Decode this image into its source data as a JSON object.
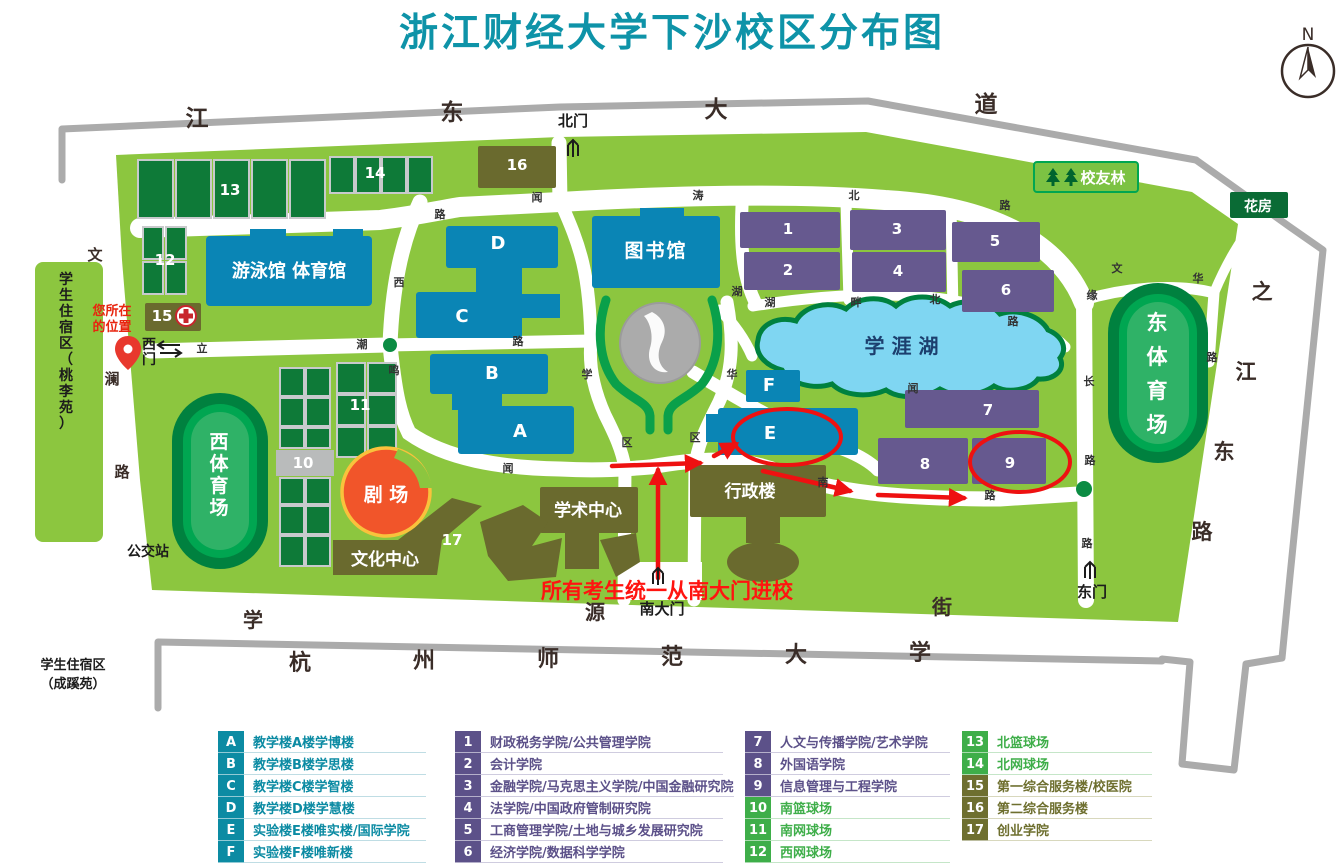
{
  "title": {
    "text": "浙江财经大学下沙校区分布图",
    "color": "#0E93A8"
  },
  "compass": {
    "label": "N"
  },
  "colors": {
    "campus_green": "#8CC63F",
    "road_edge_gray": "#ABABAB",
    "road_white": "#FFFFFF",
    "lake_water": "#7FD6F2",
    "lake_edge": "#00813F",
    "building_blue": "#0A85B5",
    "building_purple": "#66598F",
    "building_olive": "#6A6A2E",
    "court_green": "#0E7A38",
    "stadium_ring": "#00813F",
    "stadium_field": "#00A651",
    "theater_orange": "#F1552A",
    "theater_outline": "#F9C23C",
    "annotation_red": "#EE1111",
    "title_teal": "#0E93A8",
    "legend_teal": "#0C8BA3",
    "legend_purple": "#5C5189",
    "legend_green": "#3EAE49",
    "legend_olive": "#6E6F2F"
  },
  "legend": {
    "groups": [
      {
        "rows": [
          {
            "id": "A",
            "label": "教学楼A楼学博楼",
            "color": "#0C8BA3",
            "line": "#bfdde4"
          },
          {
            "id": "B",
            "label": "教学楼B楼学思楼",
            "color": "#0C8BA3",
            "line": "#bfdde4"
          },
          {
            "id": "C",
            "label": "教学楼C楼学智楼",
            "color": "#0C8BA3",
            "line": "#bfdde4"
          },
          {
            "id": "D",
            "label": "教学楼D楼学慧楼",
            "color": "#0C8BA3",
            "line": "#bfdde4"
          },
          {
            "id": "E",
            "label": "实验楼E楼唯实楼/国际学院",
            "color": "#0C8BA3",
            "line": "#bfdde4"
          },
          {
            "id": "F",
            "label": "实验楼F楼唯新楼",
            "color": "#0C8BA3",
            "line": "#bfdde4"
          }
        ]
      },
      {
        "rows": [
          {
            "id": "1",
            "label": "财政税务学院/公共管理学院",
            "color": "#5C5189",
            "line": "#cfccdf"
          },
          {
            "id": "2",
            "label": "会计学院",
            "color": "#5C5189",
            "line": "#cfccdf"
          },
          {
            "id": "3",
            "label": "金融学院/马克思主义学院/中国金融研究院",
            "color": "#5C5189",
            "line": "#cfccdf"
          },
          {
            "id": "4",
            "label": "法学院/中国政府管制研究院",
            "color": "#5C5189",
            "line": "#cfccdf"
          },
          {
            "id": "5",
            "label": "工商管理学院/土地与城乡发展研究院",
            "color": "#5C5189",
            "line": "#cfccdf"
          },
          {
            "id": "6",
            "label": "经济学院/数据科学学院",
            "color": "#5C5189",
            "line": "#cfccdf"
          }
        ]
      },
      {
        "rows": [
          {
            "id": "7",
            "label": "人文与传播学院/艺术学院",
            "color": "#5C5189",
            "line": "#cfccdf"
          },
          {
            "id": "8",
            "label": "外国语学院",
            "color": "#5C5189",
            "line": "#cfccdf"
          },
          {
            "id": "9",
            "label": "信息管理与工程学院",
            "color": "#5C5189",
            "line": "#cfccdf"
          },
          {
            "id": "10",
            "label": "南篮球场",
            "color": "#3EAE49",
            "line": "#c5e6c8"
          },
          {
            "id": "11",
            "label": "南网球场",
            "color": "#3EAE49",
            "line": "#c5e6c8"
          },
          {
            "id": "12",
            "label": "西网球场",
            "color": "#3EAE49",
            "line": "#c5e6c8"
          }
        ]
      },
      {
        "rows": [
          {
            "id": "13",
            "label": "北篮球场",
            "color": "#3EAE49",
            "line": "#c5e6c8"
          },
          {
            "id": "14",
            "label": "北网球场",
            "color": "#3EAE49",
            "line": "#c5e6c8"
          },
          {
            "id": "15",
            "label": "第一综合服务楼/校医院",
            "color": "#6E6F2F",
            "line": "#d8d8bd"
          },
          {
            "id": "16",
            "label": "第二综合服务楼",
            "color": "#6E6F2F",
            "line": "#d8d8bd"
          },
          {
            "id": "17",
            "label": "创业学院",
            "color": "#6E6F2F",
            "line": "#d8d8bd"
          }
        ]
      }
    ]
  },
  "map_texts": [
    {
      "n": "road-jiangdong-avenue",
      "t": "江",
      "x": 197,
      "y": 126,
      "s": 23,
      "c": "#3a2d28"
    },
    {
      "n": "road-jiangdong-avenue",
      "t": "东",
      "x": 452,
      "y": 120,
      "s": 23,
      "c": "#3a2d28"
    },
    {
      "n": "road-jiangdong-avenue",
      "t": "大",
      "x": 716,
      "y": 117,
      "s": 23,
      "c": "#3a2d28"
    },
    {
      "n": "road-jiangdong-avenue",
      "t": "道",
      "x": 986,
      "y": 112,
      "s": 23,
      "c": "#3a2d28"
    },
    {
      "n": "road-zhijiang-east",
      "t": "之",
      "x": 1262,
      "y": 299,
      "s": 21,
      "c": "#3a2d28"
    },
    {
      "n": "road-zhijiang-east",
      "t": "江",
      "x": 1246,
      "y": 379,
      "s": 21,
      "c": "#3a2d28"
    },
    {
      "n": "road-zhijiang-east",
      "t": "东",
      "x": 1224,
      "y": 459,
      "s": 21,
      "c": "#3a2d28"
    },
    {
      "n": "road-zhijiang-east",
      "t": "路",
      "x": 1202,
      "y": 539,
      "s": 21,
      "c": "#3a2d28"
    },
    {
      "n": "road-xueyuan-street",
      "t": "学",
      "x": 253,
      "y": 627,
      "s": 20,
      "c": "#3a2d28"
    },
    {
      "n": "road-xueyuan-street",
      "t": "源",
      "x": 595,
      "y": 619,
      "s": 20,
      "c": "#3a2d28"
    },
    {
      "n": "road-xueyuan-street",
      "t": "街",
      "x": 942,
      "y": 614,
      "s": 20,
      "c": "#3a2d28"
    },
    {
      "n": "hangzhou-normal-univ",
      "t": "杭",
      "x": 300,
      "y": 670,
      "s": 22,
      "c": "#3a2d28"
    },
    {
      "n": "hangzhou-normal-univ",
      "t": "州",
      "x": 424,
      "y": 668,
      "s": 22,
      "c": "#3a2d28"
    },
    {
      "n": "hangzhou-normal-univ",
      "t": "师",
      "x": 548,
      "y": 666,
      "s": 22,
      "c": "#3a2d28"
    },
    {
      "n": "hangzhou-normal-univ",
      "t": "范",
      "x": 672,
      "y": 664,
      "s": 22,
      "c": "#3a2d28"
    },
    {
      "n": "hangzhou-normal-univ",
      "t": "大",
      "x": 796,
      "y": 662,
      "s": 22,
      "c": "#3a2d28"
    },
    {
      "n": "hangzhou-normal-univ",
      "t": "学",
      "x": 920,
      "y": 660,
      "s": 22,
      "c": "#3a2d28"
    },
    {
      "n": "road-wenlan",
      "t": "文",
      "x": 95,
      "y": 260,
      "s": 15,
      "c": "#3a2d28"
    },
    {
      "n": "road-wenlan",
      "t": "澜",
      "x": 112,
      "y": 384,
      "s": 15,
      "c": "#3a2d28"
    },
    {
      "n": "road-wenlan",
      "t": "路",
      "x": 122,
      "y": 477,
      "s": 15,
      "c": "#3a2d28"
    },
    {
      "n": "road-char",
      "t": "闻",
      "x": 537,
      "y": 201,
      "s": 11,
      "c": "#333333"
    },
    {
      "n": "road-char",
      "t": "涛",
      "x": 698,
      "y": 199,
      "s": 11,
      "c": "#333333"
    },
    {
      "n": "road-char",
      "t": "北",
      "x": 854,
      "y": 199,
      "s": 11,
      "c": "#333333"
    },
    {
      "n": "road-char",
      "t": "路",
      "x": 1005,
      "y": 209,
      "s": 11,
      "c": "#333333"
    },
    {
      "n": "road-char",
      "t": "路",
      "x": 440,
      "y": 218,
      "s": 11,
      "c": "#333333"
    },
    {
      "n": "road-char",
      "t": "西",
      "x": 399,
      "y": 286,
      "s": 11,
      "c": "#333333"
    },
    {
      "n": "road-char",
      "t": "立",
      "x": 202,
      "y": 352,
      "s": 11,
      "c": "#333333"
    },
    {
      "n": "road-char",
      "t": "潮",
      "x": 362,
      "y": 348,
      "s": 11,
      "c": "#333333"
    },
    {
      "n": "road-char",
      "t": "鸣",
      "x": 394,
      "y": 374,
      "s": 11,
      "c": "#333333"
    },
    {
      "n": "road-char",
      "t": "路",
      "x": 518,
      "y": 345,
      "s": 11,
      "c": "#333333"
    },
    {
      "n": "road-char",
      "t": "闻",
      "x": 508,
      "y": 472,
      "s": 11,
      "c": "#333333"
    },
    {
      "n": "road-char",
      "t": "区",
      "x": 627,
      "y": 446,
      "s": 11,
      "c": "#333333"
    },
    {
      "n": "road-char",
      "t": "区",
      "x": 695,
      "y": 441,
      "s": 11,
      "c": "#333333"
    },
    {
      "n": "road-char",
      "t": "学",
      "x": 587,
      "y": 378,
      "s": 11,
      "c": "#333333"
    },
    {
      "n": "road-char",
      "t": "湖",
      "x": 737,
      "y": 295,
      "s": 11,
      "c": "#333333"
    },
    {
      "n": "road-char",
      "t": "华",
      "x": 732,
      "y": 378,
      "s": 11,
      "c": "#333333"
    },
    {
      "n": "road-char",
      "t": "湖",
      "x": 770,
      "y": 306,
      "s": 11,
      "c": "#333333"
    },
    {
      "n": "road-char",
      "t": "畔",
      "x": 856,
      "y": 306,
      "s": 11,
      "c": "#333333"
    },
    {
      "n": "road-char",
      "t": "北",
      "x": 935,
      "y": 303,
      "s": 11,
      "c": "#333333"
    },
    {
      "n": "road-char",
      "t": "路",
      "x": 1013,
      "y": 325,
      "s": 11,
      "c": "#333333"
    },
    {
      "n": "road-char",
      "t": "闻",
      "x": 913,
      "y": 392,
      "s": 11,
      "c": "#333333"
    },
    {
      "n": "road-char",
      "t": "南",
      "x": 823,
      "y": 486,
      "s": 11,
      "c": "#333333"
    },
    {
      "n": "road-char",
      "t": "路",
      "x": 990,
      "y": 499,
      "s": 11,
      "c": "#333333"
    },
    {
      "n": "road-char",
      "t": "文",
      "x": 1117,
      "y": 272,
      "s": 11,
      "c": "#333333"
    },
    {
      "n": "road-char",
      "t": "华",
      "x": 1198,
      "y": 282,
      "s": 11,
      "c": "#333333"
    },
    {
      "n": "road-char",
      "t": "路",
      "x": 1212,
      "y": 361,
      "s": 11,
      "c": "#333333"
    },
    {
      "n": "road-char",
      "t": "缘",
      "x": 1092,
      "y": 299,
      "s": 11,
      "c": "#333333"
    },
    {
      "n": "road-char",
      "t": "长",
      "x": 1089,
      "y": 385,
      "s": 11,
      "c": "#333333"
    },
    {
      "n": "road-char",
      "t": "路",
      "x": 1090,
      "y": 464,
      "s": 11,
      "c": "#333333"
    },
    {
      "n": "road-char",
      "t": "路",
      "x": 1087,
      "y": 547,
      "s": 11,
      "c": "#333333"
    },
    {
      "n": "gate-north-label",
      "t": "北门",
      "x": 573,
      "y": 126,
      "s": 15,
      "c": "#1c1c1c"
    },
    {
      "n": "gate-south-label",
      "t": "南大门",
      "x": 662,
      "y": 614,
      "s": 15,
      "c": "#1c1c1c"
    },
    {
      "n": "gate-east-label",
      "t": "东门",
      "x": 1092,
      "y": 597,
      "s": 15,
      "c": "#1c1c1c"
    },
    {
      "n": "gate-west-label",
      "t": "西",
      "x": 149,
      "y": 349,
      "s": 14,
      "c": "#1c1c1c"
    },
    {
      "n": "gate-west-label",
      "t": "门",
      "x": 149,
      "y": 364,
      "s": 14,
      "c": "#1c1c1c"
    },
    {
      "n": "bus-stop-label",
      "t": "公交站",
      "x": 148,
      "y": 556,
      "s": 14,
      "c": "#1c1c1c"
    },
    {
      "n": "dorm-south-label",
      "t": "学生住宿区",
      "x": 73,
      "y": 669,
      "s": 13,
      "c": "#1c1c1c"
    },
    {
      "n": "dorm-south-label",
      "t": "（成蹊苑）",
      "x": 73,
      "y": 688,
      "s": 13,
      "c": "#1c1c1c"
    },
    {
      "n": "dorm-west-label",
      "t": "学生住宿区（桃李苑）",
      "x": 66,
      "y": 284,
      "s": 14,
      "c": "#1c1c1c",
      "v": true,
      "st": 16
    },
    {
      "n": "your-location-label",
      "t": "您所在",
      "x": 112,
      "y": 315,
      "s": 13,
      "c": "#E8250F"
    },
    {
      "n": "your-location-label",
      "t": "的位置",
      "x": 112,
      "y": 331,
      "s": 13,
      "c": "#E8250F"
    },
    {
      "n": "entry-notice",
      "t": "所有考生统一从南大门进校",
      "x": 667,
      "y": 598,
      "s": 21,
      "c": "#FF1410"
    },
    {
      "n": "alumni-forest-label",
      "t": "校友林",
      "x": 1103,
      "y": 183,
      "s": 15,
      "c": "#ffffff"
    },
    {
      "n": "greenhouse-label",
      "t": "花房",
      "x": 1258,
      "y": 211,
      "s": 14,
      "c": "#ffffff"
    },
    {
      "n": "lake-label",
      "t": "学涯湖",
      "x": 905,
      "y": 353,
      "s": 20,
      "c": "#1c3f6e",
      "ls": 7
    },
    {
      "n": "library-label",
      "t": "图书馆",
      "x": 656,
      "y": 257,
      "s": 19,
      "c": "#ffffff",
      "ls": 2
    },
    {
      "n": "natatorium-label",
      "t": "游泳馆 体育馆",
      "x": 289,
      "y": 277,
      "s": 18,
      "c": "#ffffff"
    },
    {
      "n": "theater-label",
      "t": "剧 场",
      "x": 386,
      "y": 501,
      "s": 19,
      "c": "#ffffff"
    },
    {
      "n": "culture-center-label",
      "t": "文化中心",
      "x": 385,
      "y": 565,
      "s": 17,
      "c": "#ffffff"
    },
    {
      "n": "building-17-label",
      "t": "17",
      "x": 452,
      "y": 545,
      "s": 15,
      "c": "#ffffff"
    },
    {
      "n": "academic-center-label",
      "t": "学术中心",
      "x": 588,
      "y": 516,
      "s": 17,
      "c": "#ffffff"
    },
    {
      "n": "admin-building-label",
      "t": "行政楼",
      "x": 750,
      "y": 497,
      "s": 17,
      "c": "#ffffff"
    },
    {
      "n": "west-stadium-label",
      "t": "西体育场",
      "x": 219,
      "y": 448,
      "s": 19,
      "c": "#ffffff",
      "v": true,
      "st": 22
    },
    {
      "n": "east-stadium-label",
      "t": "东体育场",
      "x": 1157,
      "y": 330,
      "s": 21,
      "c": "#ffffff",
      "v": true,
      "st": 34
    },
    {
      "n": "building-a-label",
      "t": "A",
      "x": 520,
      "y": 437,
      "s": 18,
      "c": "#ffffff"
    },
    {
      "n": "building-b-label",
      "t": "B",
      "x": 492,
      "y": 379,
      "s": 18,
      "c": "#ffffff"
    },
    {
      "n": "building-c-label",
      "t": "C",
      "x": 462,
      "y": 322,
      "s": 18,
      "c": "#ffffff"
    },
    {
      "n": "building-d-label",
      "t": "D",
      "x": 498,
      "y": 249,
      "s": 18,
      "c": "#ffffff"
    },
    {
      "n": "building-e-label",
      "t": "E",
      "x": 770,
      "y": 439,
      "s": 18,
      "c": "#ffffff"
    },
    {
      "n": "building-f-label",
      "t": "F",
      "x": 769,
      "y": 391,
      "s": 18,
      "c": "#ffffff"
    },
    {
      "n": "building-1-label",
      "t": "1",
      "x": 788,
      "y": 234,
      "s": 15,
      "c": "#ffffff"
    },
    {
      "n": "building-2-label",
      "t": "2",
      "x": 788,
      "y": 275,
      "s": 15,
      "c": "#ffffff"
    },
    {
      "n": "building-3-label",
      "t": "3",
      "x": 897,
      "y": 234,
      "s": 15,
      "c": "#ffffff"
    },
    {
      "n": "building-4-label",
      "t": "4",
      "x": 898,
      "y": 276,
      "s": 15,
      "c": "#ffffff"
    },
    {
      "n": "building-5-label",
      "t": "5",
      "x": 995,
      "y": 246,
      "s": 15,
      "c": "#ffffff"
    },
    {
      "n": "building-6-label",
      "t": "6",
      "x": 1006,
      "y": 295,
      "s": 15,
      "c": "#ffffff"
    },
    {
      "n": "building-7-label",
      "t": "7",
      "x": 988,
      "y": 415,
      "s": 15,
      "c": "#ffffff"
    },
    {
      "n": "building-8-label",
      "t": "8",
      "x": 925,
      "y": 469,
      "s": 15,
      "c": "#ffffff"
    },
    {
      "n": "building-9-label",
      "t": "9",
      "x": 1010,
      "y": 468,
      "s": 15,
      "c": "#ffffff"
    },
    {
      "n": "court-10-label",
      "t": "10",
      "x": 303,
      "y": 468,
      "s": 15,
      "c": "#ffffff"
    },
    {
      "n": "court-11-label",
      "t": "11",
      "x": 360,
      "y": 410,
      "s": 15,
      "c": "#ffffff"
    },
    {
      "n": "court-12-label",
      "t": "12",
      "x": 165,
      "y": 265,
      "s": 15,
      "c": "#ffffff"
    },
    {
      "n": "court-13-label",
      "t": "13",
      "x": 230,
      "y": 195,
      "s": 15,
      "c": "#ffffff"
    },
    {
      "n": "court-14-label",
      "t": "14",
      "x": 375,
      "y": 178,
      "s": 15,
      "c": "#ffffff"
    },
    {
      "n": "building-15-label",
      "t": "15",
      "x": 162,
      "y": 321,
      "s": 15,
      "c": "#ffffff"
    },
    {
      "n": "building-16-label",
      "t": "16",
      "x": 517,
      "y": 170,
      "s": 15,
      "c": "#ffffff"
    }
  ]
}
